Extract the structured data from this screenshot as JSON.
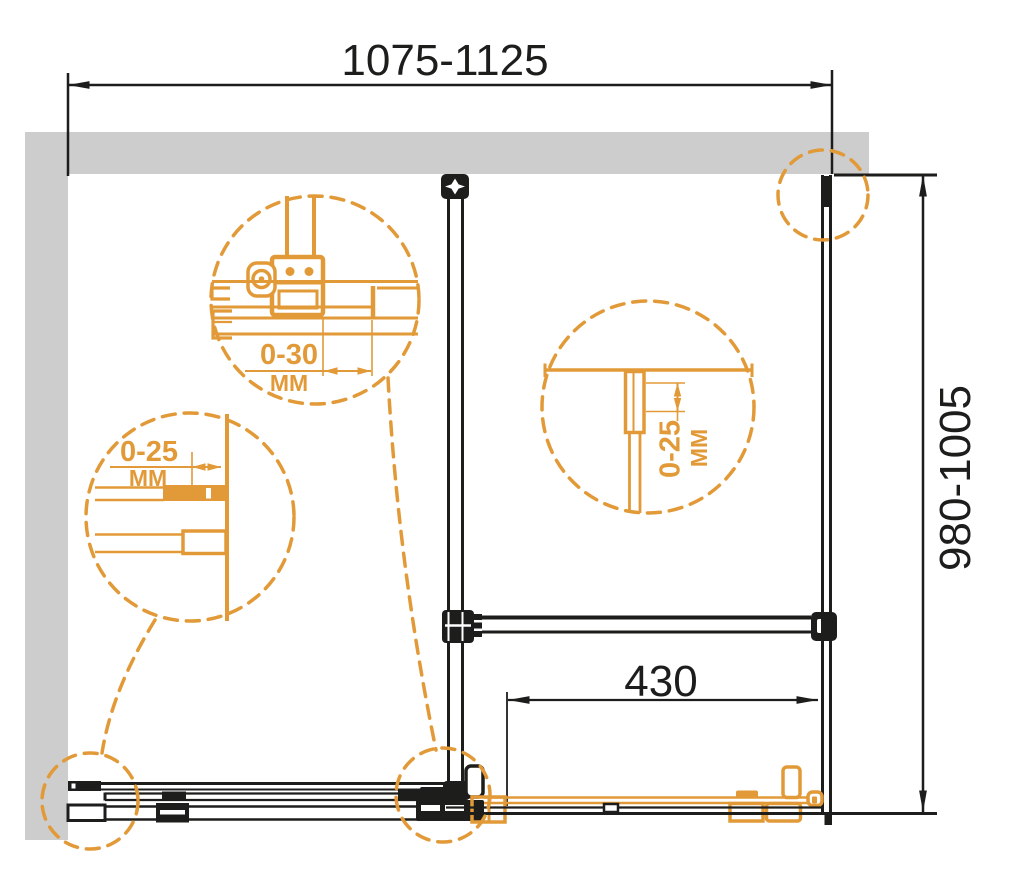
{
  "drawing": {
    "colors": {
      "accent": "#E29A38",
      "line": "#1D1D1B",
      "wall": "#CDCDCD",
      "bg": "#FFFFFF"
    },
    "dimensions": {
      "width": {
        "value": "1075-1125"
      },
      "depth": {
        "value": "980-1005"
      },
      "door_width": {
        "value": "430"
      }
    },
    "details": {
      "roller": {
        "range": "0-30",
        "unit": "MM"
      },
      "wall_profile": {
        "range": "0-25",
        "unit": "MM"
      },
      "top_profile": {
        "range": "0-25",
        "unit": "MM"
      }
    }
  }
}
